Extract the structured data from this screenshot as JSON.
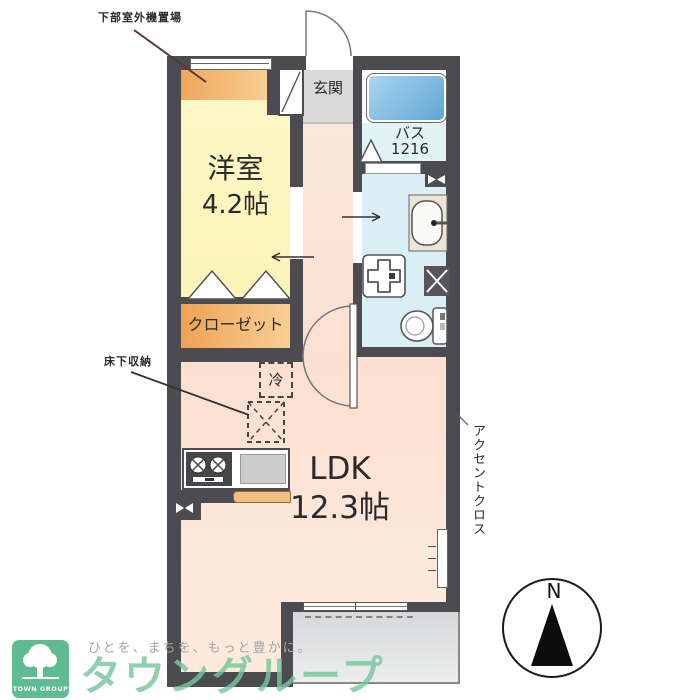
{
  "plan": {
    "rooms": {
      "western_room": {
        "name": "洋室",
        "size": "4.2帖"
      },
      "ldk": {
        "name": "LDK",
        "size": "12.3帖"
      },
      "closet": {
        "name": "クローゼット"
      },
      "entrance": {
        "name": "玄関"
      },
      "bath": {
        "name": "バス",
        "size": "1216"
      }
    },
    "fixtures": {
      "refrigerator_label": "冷"
    },
    "annotations": {
      "outdoor_unit": "下部室外機置場",
      "underfloor_storage": "床下収納",
      "accent_cloth": "アクセントクロス"
    },
    "compass_north": "N"
  },
  "branding": {
    "logo_square_text": "TOWN GROUP",
    "tagline": "ひとを、まちを、もっと豊かに。",
    "brand_name": "タウングループ"
  },
  "colors": {
    "wall": "#4c4c50",
    "western_room_yellow": "#fdf7c6",
    "closet_orange": "#f2ae62",
    "ldk_peach": "#fbe2d6",
    "bath_floor_cyan": "#def2f4",
    "bathtub_blue": "#6fb2dd",
    "balcony_gray": "#d9dadb",
    "entrance_gray": "#d9d9d9",
    "brand_green": "#6fc091"
  }
}
